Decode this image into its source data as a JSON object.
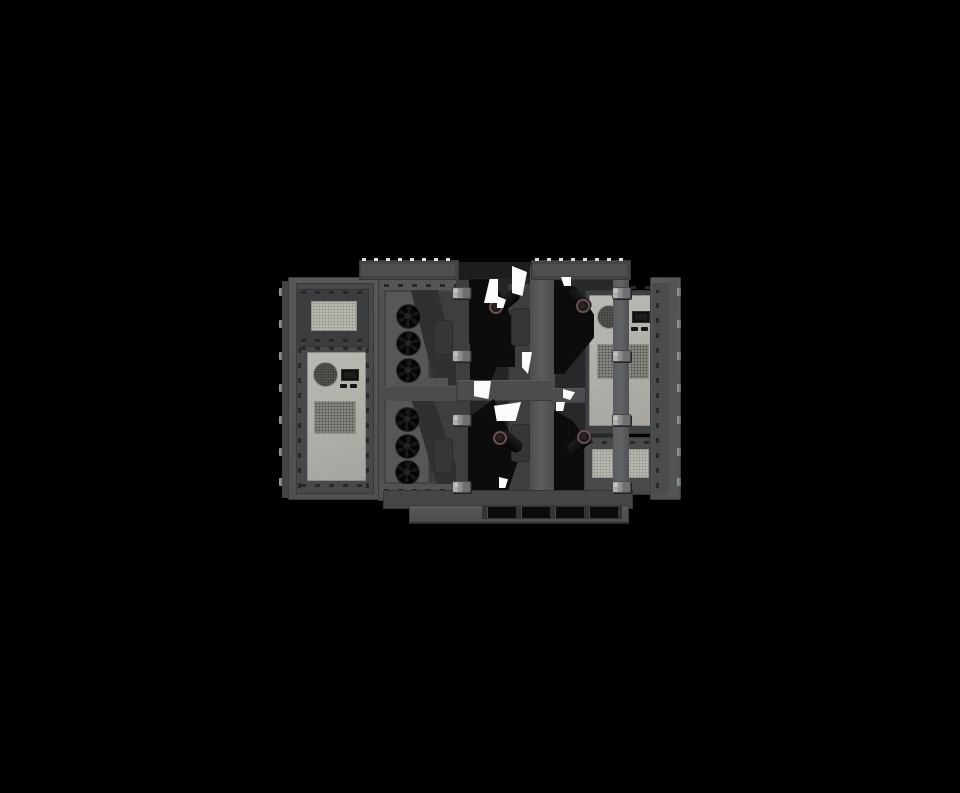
{
  "scene": {
    "type": "3d-product-render",
    "subject": "front view of an industrial outdoor electronics cabinet assembly with open doors, heat-exchanger units, fan banks, air ducts and toggle latches on a black background",
    "background_color": "#000000",
    "contains_text": false
  },
  "palette": {
    "body_gray": "#525355",
    "frame_dark": "#3c3d3f",
    "recess": "#47484a",
    "cavity_black": "#0c0c0d",
    "panel_beige": "#b4b3ad",
    "grille_light": "#b9b9b3",
    "latch_metal": "#9e9e9e",
    "lens_rim": "#6a5050",
    "gap_white": "#fbfbfb"
  },
  "fans": {
    "size": 23,
    "items": [
      {
        "cx": 407,
        "cy": 315
      },
      {
        "cx": 407,
        "cy": 342
      },
      {
        "cx": 407,
        "cy": 369
      },
      {
        "cx": 406,
        "cy": 418
      },
      {
        "cx": 406,
        "cy": 445
      },
      {
        "cx": 406,
        "cy": 471
      }
    ]
  },
  "latches": {
    "width": 17,
    "height": 10,
    "left_x": 452,
    "right_x": 612,
    "y": [
      287,
      350,
      414,
      481
    ]
  },
  "hinge_pins": {
    "width": 4,
    "height": 8,
    "left_x": 279,
    "right_x": 677,
    "y": [
      288,
      320,
      352,
      384,
      416,
      448,
      478
    ]
  },
  "rail_cells": [
    {
      "x": 434,
      "y": 320,
      "w": 17,
      "h": 33
    },
    {
      "x": 434,
      "y": 438,
      "w": 17,
      "h": 33
    },
    {
      "x": 511,
      "y": 308,
      "w": 17,
      "h": 36
    },
    {
      "x": 511,
      "y": 424,
      "w": 17,
      "h": 36
    }
  ],
  "optics": [
    {
      "bx": 494,
      "by": 294,
      "rot": -38,
      "lx": 489,
      "ly": 300
    },
    {
      "bx": 497,
      "by": 435,
      "rot": 38,
      "lx": 493,
      "ly": 431
    },
    {
      "bx": 566,
      "by": 294,
      "rot": 40,
      "lx": 576,
      "ly": 299
    },
    {
      "bx": 566,
      "by": 437,
      "rot": -40,
      "lx": 577,
      "ly": 430
    }
  ],
  "white_shards": [
    {
      "x": 484,
      "y": 279,
      "w": 14,
      "h": 24,
      "clip": "polygon(100% 0,100% 100%,0 100%,40% 0)"
    },
    {
      "x": 512,
      "y": 266,
      "w": 15,
      "h": 30,
      "clip": "polygon(0 0,100% 20%,70% 100%,0 90%)"
    },
    {
      "x": 497,
      "y": 296,
      "w": 9,
      "h": 12,
      "clip": "polygon(0 0,100% 30%,70% 100%,0 100%)"
    },
    {
      "x": 474,
      "y": 381,
      "w": 17,
      "h": 18,
      "clip": "polygon(0 0,100% 0,85% 100%,0 85%)"
    },
    {
      "x": 494,
      "y": 402,
      "w": 27,
      "h": 19,
      "clip": "polygon(0 20%,100% 0,80% 100%,10% 100%)"
    },
    {
      "x": 522,
      "y": 352,
      "w": 10,
      "h": 22,
      "clip": "polygon(0 0,100% 0,60% 100%,0 70%)"
    },
    {
      "x": 561,
      "y": 277,
      "w": 10,
      "h": 9,
      "clip": "polygon(0 0,100% 0,100% 100%,30% 100%)"
    },
    {
      "x": 563,
      "y": 389,
      "w": 12,
      "h": 11,
      "clip": "polygon(0 0,100% 30%,60% 100%,0 80%)"
    },
    {
      "x": 556,
      "y": 402,
      "w": 9,
      "h": 9,
      "clip": "polygon(0 0,100% 0,80% 100%,0 100%)"
    },
    {
      "x": 499,
      "y": 477,
      "w": 9,
      "h": 11,
      "clip": "polygon(0 0,100% 20%,70% 100%,0 100%)"
    }
  ],
  "base_slots": {
    "y": 507,
    "w": 28,
    "h": 11,
    "x": [
      487,
      521,
      555,
      589
    ]
  }
}
